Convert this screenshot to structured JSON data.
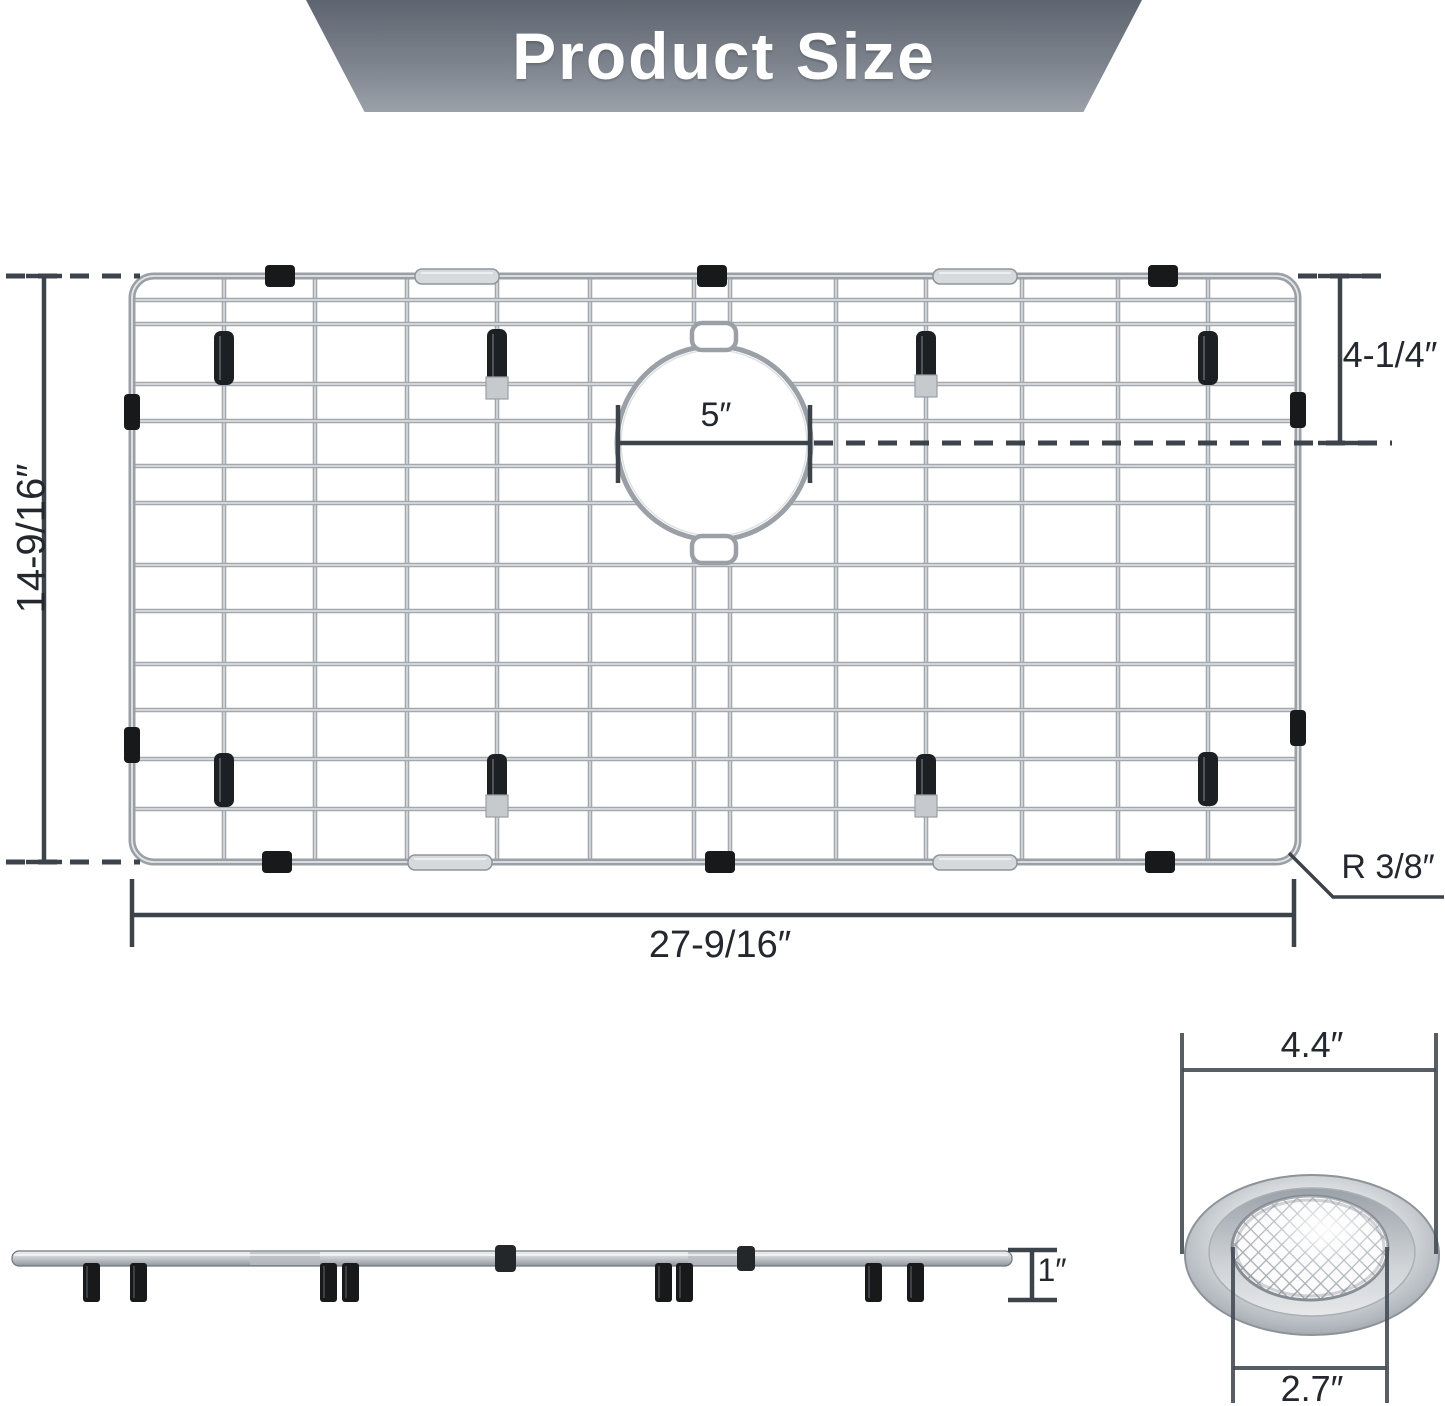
{
  "header": {
    "title": "Product Size"
  },
  "top_view": {
    "description": "sink bottom grid with center drain hole",
    "height_label": "14-9/16″",
    "width_label": "27-9/16″",
    "hole_diameter_label": "5″",
    "hole_offset_label": "4-1/4″",
    "corner_radius_label": "R 3/8″"
  },
  "side_view": {
    "thickness_label": "1″"
  },
  "strainer_view": {
    "outer_diameter_label": "4.4″",
    "mesh_diameter_label": "2.7″"
  },
  "colors": {
    "dimension_line": "#3d434a",
    "wire": "#a2a8ae",
    "clip_black": "#17191b",
    "banner_top": "#5f6570",
    "banner_bottom": "#9aa1a9"
  }
}
